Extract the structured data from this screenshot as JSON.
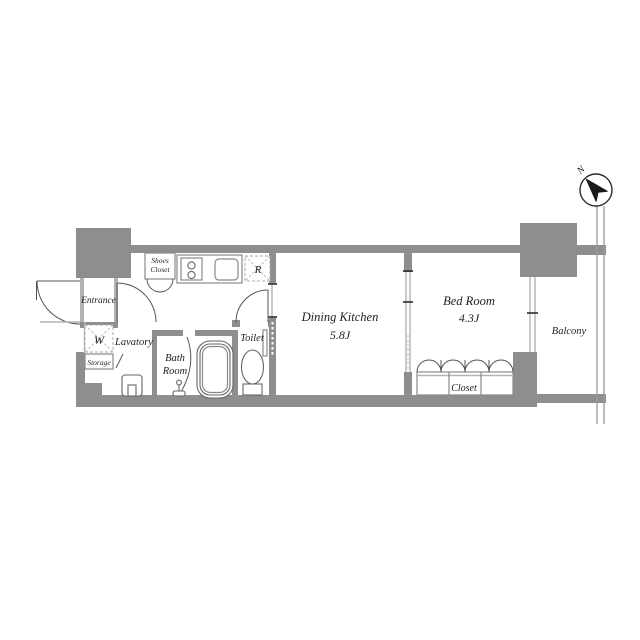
{
  "title": "1K apartment floor plan",
  "compass": {
    "north_label": "N"
  },
  "rooms": {
    "entrance": {
      "label": "Entrance"
    },
    "shoes_closet": {
      "label_line1": "Shoes",
      "label_line2": "Closet"
    },
    "washing_machine": {
      "label": "W"
    },
    "lavatory": {
      "label": "Lavatory"
    },
    "storage": {
      "label": "Storage"
    },
    "bath_room": {
      "label_line1": "Bath",
      "label_line2": "Room"
    },
    "toilet": {
      "label": "Toilet"
    },
    "refrigerator": {
      "label": "R"
    },
    "dining_kitchen": {
      "label": "Dining Kitchen",
      "area": "5.8J"
    },
    "bed_room": {
      "label": "Bed Room",
      "area": "4.3J"
    },
    "closet": {
      "label": "Closet"
    },
    "balcony": {
      "label": "Balcony"
    }
  },
  "colors": {
    "wall": "#8e8e8e",
    "light_line": "#b3b3b3",
    "fixture_line": "#666666",
    "text": "#1f1f1f",
    "background": "#ffffff",
    "compass_needle": "#1a1a1a"
  }
}
